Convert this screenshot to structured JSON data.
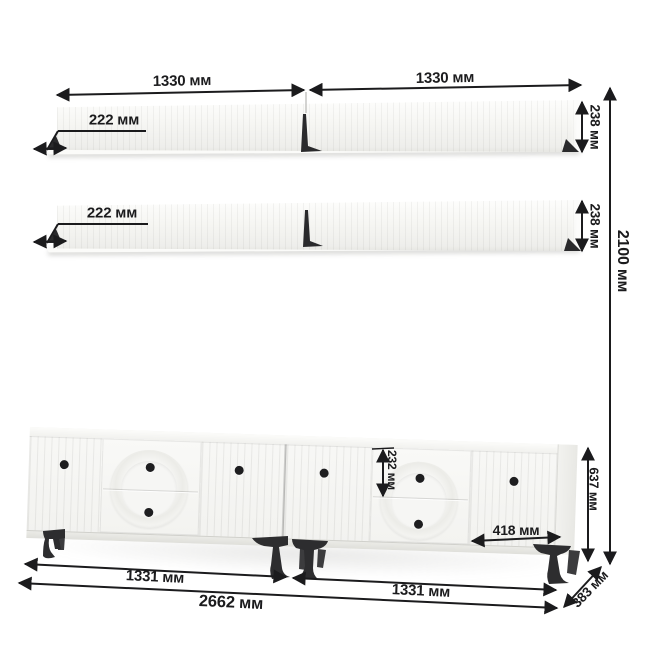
{
  "diagram": {
    "kind": "furniture-dimension-drawing",
    "units": "мм"
  },
  "dims": {
    "shelf_width_left": "1330 мм",
    "shelf_width_right": "1330 мм",
    "shelf1_depth": "222 мм",
    "shelf1_height": "238 мм",
    "shelf2_depth": "222 мм",
    "shelf2_height": "238 мм",
    "total_height": "2100 мм",
    "drawer_height": "232 мм",
    "door_width": "418 мм",
    "stand_height": "637 мм",
    "stand_width_left": "1331 мм",
    "stand_width_right": "1331 мм",
    "total_width": "2662 мм",
    "stand_depth": "383 мм"
  },
  "colors": {
    "ink": "#1b1b1d",
    "furniture": "#f6f6f3",
    "legs": "#2d2d2f",
    "background": "#ffffff"
  }
}
